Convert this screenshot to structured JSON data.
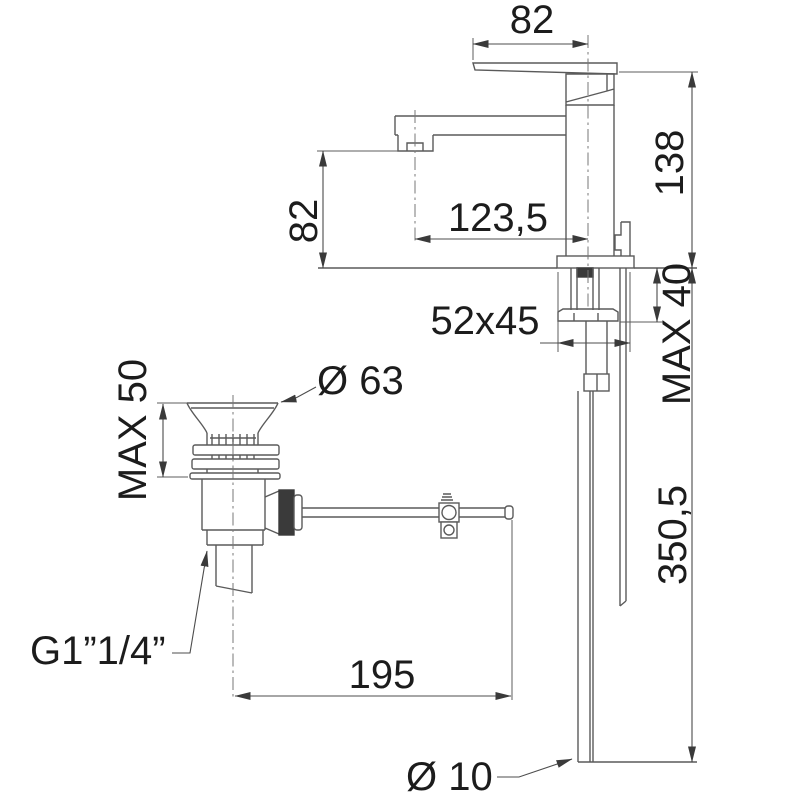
{
  "drawing": {
    "type": "faucet-dimension-drawing",
    "colors": {
      "line": "#5a5a5a",
      "dimension_line": "#4c4c4c",
      "text": "#1c1c1c",
      "background": "#ffffff"
    }
  },
  "labels": {
    "handle_length": "82",
    "overall_height": "138",
    "spout_height": "82",
    "spout_reach": "123,5",
    "base_footprint": "52x45",
    "max_deck_thickness": "MAX 40",
    "max_clamp_range": "MAX 50",
    "waste_flange_diameter": "Ø 63",
    "hose_length": "350,5",
    "waste_thread": "G1”1/4”",
    "rod_length": "195",
    "hose_diameter": "Ø 10"
  }
}
